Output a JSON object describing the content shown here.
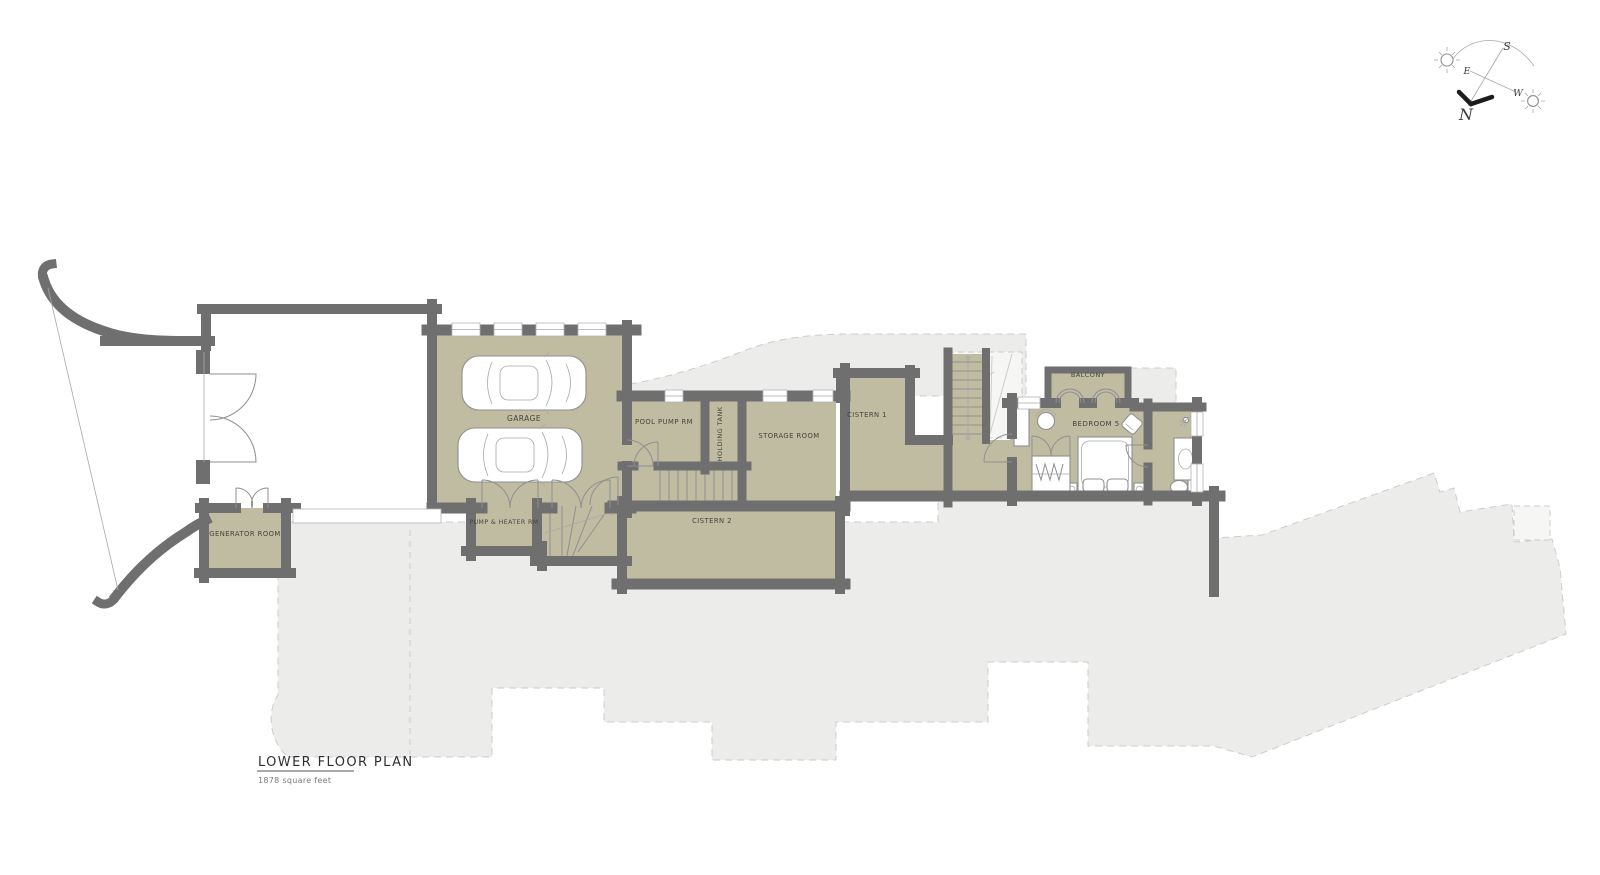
{
  "title": {
    "heading": "LOWER FLOOR PLAN",
    "subtitle": "1878 square feet"
  },
  "compass": {
    "n": "N",
    "s": "S",
    "e": "E",
    "w": "W"
  },
  "rooms": {
    "garage": "GARAGE",
    "generator": "GENERATOR ROOM",
    "pool_pump": "POOL PUMP RM",
    "holding_tank": "HOLDING TANK",
    "storage": "STORAGE ROOM",
    "cistern1": "CISTERN 1",
    "cistern2": "CISTERN 2",
    "pump_heater": "PUMP & HEATER RM",
    "bedroom5": "BEDROOM 5",
    "balcony": "BALCONY"
  },
  "colors": {
    "room_fill": "#bfbca2",
    "wall": "#6f6f6f",
    "ghost_fill": "#ececeb",
    "ghost_stroke": "#cccccb",
    "ghost_fill_light": "#f6f6f5",
    "line": "#8f8f8f",
    "thin": "#a8a8a8",
    "text": "#45443a",
    "title_text": "#2f2f2f",
    "subtitle_text": "#7a7a74"
  }
}
